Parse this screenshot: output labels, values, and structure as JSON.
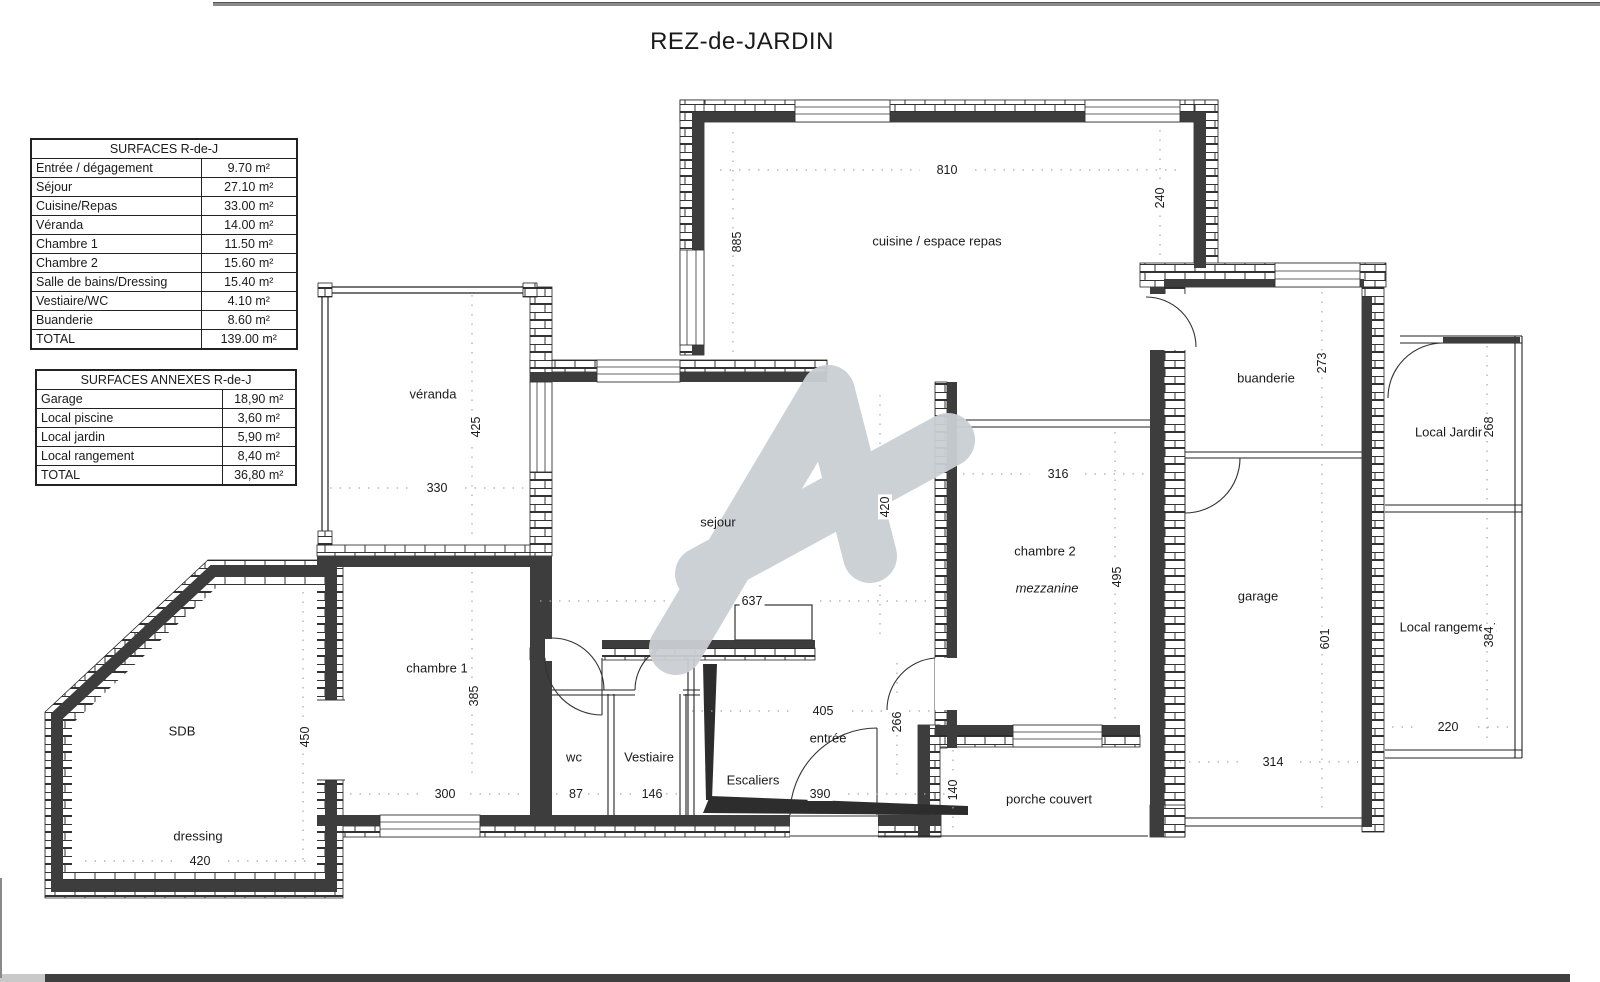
{
  "title": "REZ-de-JARDIN",
  "tables": {
    "surfaces": {
      "title": "SURFACES R-de-J",
      "rows": [
        {
          "label": "Entrée / dégagement",
          "value": "9.70 m²"
        },
        {
          "label": "Séjour",
          "value": "27.10 m²"
        },
        {
          "label": "Cuisine/Repas",
          "value": "33.00 m²"
        },
        {
          "label": "Véranda",
          "value": "14.00 m²"
        },
        {
          "label": "Chambre 1",
          "value": "11.50 m²"
        },
        {
          "label": "Chambre 2",
          "value": "15.60 m²"
        },
        {
          "label": "Salle de bains/Dressing",
          "value": "15.40 m²"
        },
        {
          "label": "Vestiaire/WC",
          "value": "4.10 m²"
        },
        {
          "label": "Buanderie",
          "value": "8.60 m²"
        },
        {
          "label": "TOTAL",
          "value": "139.00 m²"
        }
      ]
    },
    "annexes": {
      "title": "SURFACES ANNEXES R-de-J",
      "rows": [
        {
          "label": "Garage",
          "value": "18,90 m²"
        },
        {
          "label": "Local piscine",
          "value": "3,60 m²"
        },
        {
          "label": "Local jardin",
          "value": "5,90 m²"
        },
        {
          "label": "Local rangement",
          "value": "8,40 m²"
        },
        {
          "label": "TOTAL",
          "value": "36,80 m²"
        }
      ]
    }
  },
  "plan": {
    "rooms": {
      "cuisine": "cuisine / espace repas",
      "veranda": "véranda",
      "sejour": "sejour",
      "chambre2": "chambre 2",
      "mezzanine": "mezzanine",
      "buanderie": "buanderie",
      "local_jardin": "Local Jardin",
      "garage": "garage",
      "local_rangement": "Local rangement",
      "sdb": "SDB",
      "dressing": "dressing",
      "chambre1": "chambre 1",
      "wc": "wc",
      "vestiaire": "Vestiaire",
      "escaliers": "Escaliers",
      "entree": "entrée",
      "porche": "porche couvert"
    },
    "dims": {
      "cuisine_w": "810",
      "cuisine_h": "885",
      "cuisine_right_h": "240",
      "veranda_h": "425",
      "veranda_w": "330",
      "sejour_w": "637",
      "sejour_h": "420",
      "chambre2_w": "316",
      "chambre2_h": "495",
      "buanderie_h": "273",
      "local_jardin_h": "268",
      "garage_h": "601",
      "garage_w": "314",
      "local_rangement_h": "384",
      "local_rangement_w": "220",
      "sdb_h": "450",
      "dressing_w": "420",
      "chambre1_h": "385",
      "chambre1_w": "300",
      "wc_w": "87",
      "vestiaire_w": "146",
      "escaliers_w": "390",
      "entree_w": "405",
      "entree_h": "266",
      "porche_h": "140"
    }
  },
  "colors": {
    "wall_dark": "#3d3d3d",
    "watermark": "#cacfd4",
    "dotted": "#a8a8a8"
  }
}
